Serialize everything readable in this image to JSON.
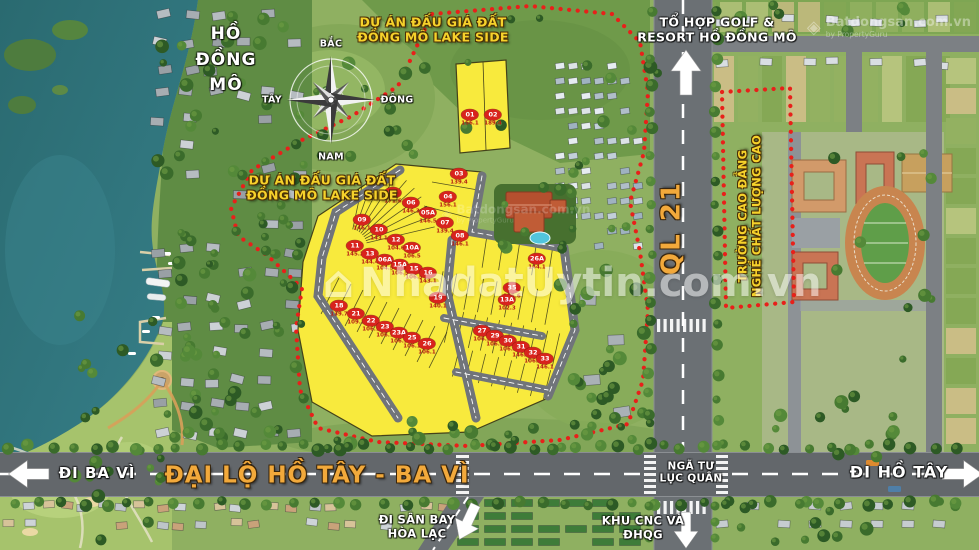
{
  "map": {
    "labels": {
      "lake": "HỒ\nĐỒNG\nMÔ",
      "project_top": "DỰ ÁN ĐẤU GIÁ ĐẤT\nĐỒNG MÔ LAKE SIDE",
      "project_left": "DỰ ÁN ĐẤU GIÁ ĐẤT\nĐỒNG MÔ LAKE SIDE",
      "golf_resort": "TỔ HỢP GOLF &\nRESORT HỒ ĐỒNG MÔ",
      "highway": "QL 21",
      "college": "TRƯỜNG CAO ĐẲNG\nNGHỀ CHẤT LƯỢNG CAO",
      "go_ba_vi": "ĐI BA VÌ",
      "boulevard": "ĐẠI LỘ HỒ TÂY - BA VÌ",
      "intersection": "NGÃ TƯ\nLỤC QUÂN",
      "go_ho_tay": "ĐI HỒ TÂY",
      "go_airport": "ĐI SÂN BAY\nHÒA LẠC",
      "tech_park": "KHU CNC VÀ\nĐHQG"
    },
    "compass": {
      "north": "BẮC",
      "south": "NAM",
      "east": "ĐÔNG",
      "west": "TÂY"
    },
    "watermarks": {
      "center": "NhadatUytin.com.vn",
      "center_icon": "⌂",
      "brand": "Batdongsan.com.vn",
      "brand_sub": "by PropertyGuru",
      "brand_icon": "◈"
    },
    "colors": {
      "plot_yellow": "#f8ea3d",
      "marker_red": "#d8231d",
      "boundary_red": "#e8201a",
      "road_label_orange": "#f2a93b",
      "project_label_yellow": "#f6d22b"
    },
    "plots": [
      {
        "no": "01",
        "area": "156.1",
        "x": 470,
        "y": 118
      },
      {
        "no": "02",
        "area": "189.4",
        "x": 493,
        "y": 118
      },
      {
        "no": "03",
        "area": "139.4",
        "x": 459,
        "y": 177
      },
      {
        "no": "04",
        "area": "156.1",
        "x": 448,
        "y": 200
      },
      {
        "no": "05",
        "area": "171.6",
        "x": 393,
        "y": 196
      },
      {
        "no": "06",
        "area": "146.3",
        "x": 411,
        "y": 206
      },
      {
        "no": "05A",
        "area": "146.5",
        "x": 428,
        "y": 216
      },
      {
        "no": "07",
        "area": "139.4",
        "x": 445,
        "y": 226
      },
      {
        "no": "09",
        "area": "146.1",
        "x": 362,
        "y": 223
      },
      {
        "no": "10",
        "area": "143.1",
        "x": 379,
        "y": 233
      },
      {
        "no": "12",
        "area": "104.6",
        "x": 396,
        "y": 243
      },
      {
        "no": "10A",
        "area": "106.5",
        "x": 412,
        "y": 251
      },
      {
        "no": "08",
        "area": "146.1",
        "x": 460,
        "y": 239
      },
      {
        "no": "11",
        "area": "145.2",
        "x": 355,
        "y": 249
      },
      {
        "no": "13",
        "area": "144.4",
        "x": 370,
        "y": 257
      },
      {
        "no": "06A",
        "area": "104.5",
        "x": 385,
        "y": 263
      },
      {
        "no": "15A",
        "area": "106.5",
        "x": 400,
        "y": 268
      },
      {
        "no": "15",
        "area": "106.5",
        "x": 414,
        "y": 272
      },
      {
        "no": "16",
        "area": "143.1",
        "x": 428,
        "y": 276
      },
      {
        "no": "18",
        "area": "139.7",
        "x": 339,
        "y": 309
      },
      {
        "no": "21",
        "area": "109.1",
        "x": 356,
        "y": 317
      },
      {
        "no": "22",
        "area": "106.1",
        "x": 371,
        "y": 324
      },
      {
        "no": "23",
        "area": "106.1",
        "x": 385,
        "y": 330
      },
      {
        "no": "23A",
        "area": "106.1",
        "x": 399,
        "y": 336
      },
      {
        "no": "25",
        "area": "106.1",
        "x": 412,
        "y": 341
      },
      {
        "no": "26",
        "area": "106.1",
        "x": 427,
        "y": 347
      },
      {
        "no": "26A",
        "area": "144.1",
        "x": 537,
        "y": 262
      },
      {
        "no": "35",
        "area": "115.6",
        "x": 512,
        "y": 291
      },
      {
        "no": "19",
        "area": "140.1",
        "x": 438,
        "y": 301
      },
      {
        "no": "13A",
        "area": "102.3",
        "x": 507,
        "y": 303
      },
      {
        "no": "27",
        "area": "106.3",
        "x": 482,
        "y": 334
      },
      {
        "no": "29",
        "area": "106.3",
        "x": 495,
        "y": 339
      },
      {
        "no": "30",
        "area": "106.3",
        "x": 508,
        "y": 344
      },
      {
        "no": "31",
        "area": "146.1",
        "x": 521,
        "y": 350
      },
      {
        "no": "32",
        "area": "106.3",
        "x": 533,
        "y": 356
      },
      {
        "no": "33",
        "area": "146.1",
        "x": 545,
        "y": 362
      }
    ]
  }
}
